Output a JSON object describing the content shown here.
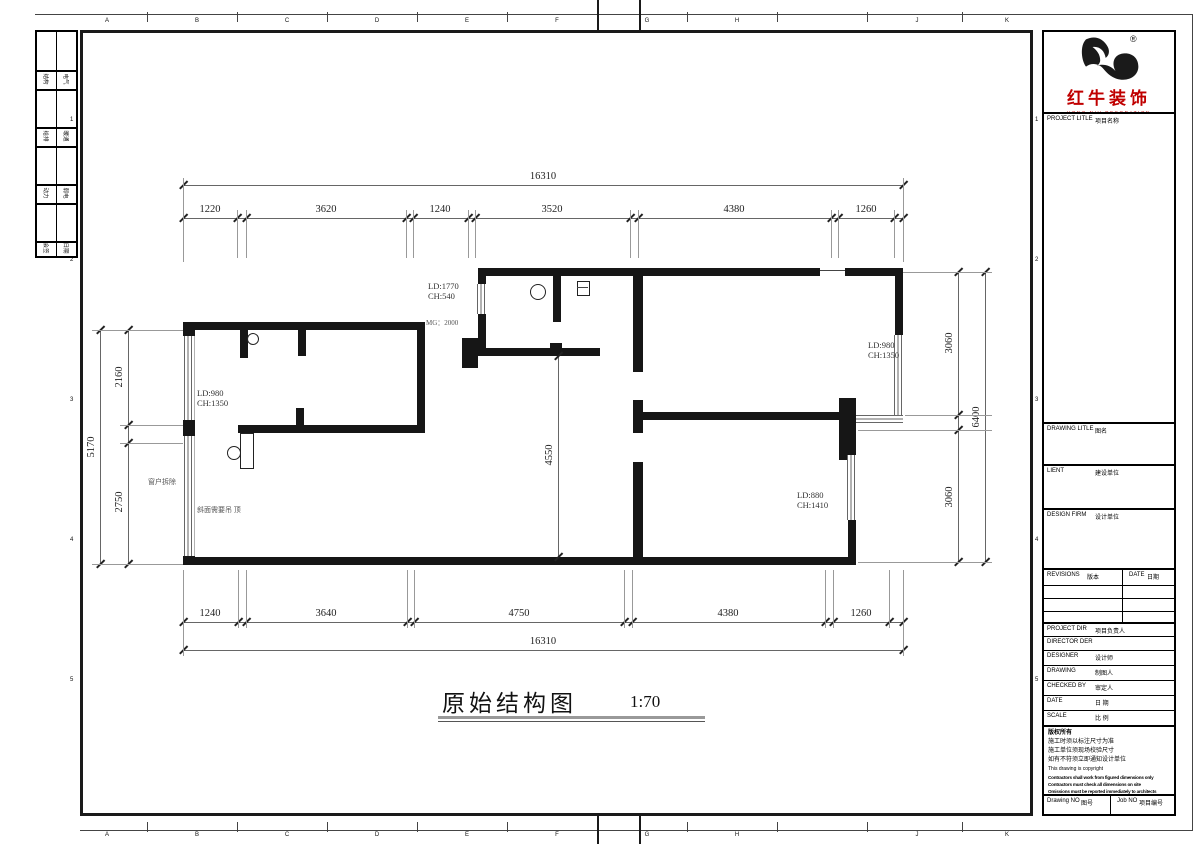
{
  "sheet": {
    "grid_letters": [
      "A",
      "B",
      "C",
      "D",
      "E",
      "F",
      "G",
      "H",
      "J",
      "K"
    ],
    "grid_numbers": [
      "1",
      "2",
      "3",
      "4",
      "5"
    ]
  },
  "signoff": {
    "rows": [
      {
        "l": "结构",
        "r": "电气"
      },
      {
        "l": "给排",
        "r": "暖通"
      },
      {
        "l": "动力",
        "r": "弱电"
      },
      {
        "l": "会签",
        "r": "日期"
      }
    ]
  },
  "plan": {
    "title": "原始结构图",
    "scale": "1:70",
    "dims_top": {
      "overall": "16310",
      "segments": [
        "1220",
        "3620",
        "1240",
        "3520",
        "4380",
        "1260"
      ]
    },
    "dims_bottom": {
      "overall": "16310",
      "segments": [
        "1240",
        "3640",
        "4750",
        "4380",
        "1260"
      ]
    },
    "dims_left": {
      "overall": "5170",
      "upper": "2160",
      "lower": "2750"
    },
    "dims_right": {
      "overall": "6400",
      "upper": "3060",
      "lower": "3060"
    },
    "dim_center": "4550",
    "labels": {
      "tc_ld": "LD:1770",
      "tc_ch": "CH:540",
      "mg": "MG：2000",
      "lt_ld": "LD:980",
      "lt_ch": "CH:1350",
      "rt_ld": "LD:980",
      "rt_ch": "CH:1350",
      "rm_ld": "LD:880",
      "rm_ch": "CH:1410",
      "window_note": "窗户拆除",
      "slope_note": "斜面需要吊 顶"
    }
  },
  "titleblock": {
    "brand": {
      "name": "红牛装饰",
      "caption": "HONG NIU DECORATION",
      "registered": "®"
    },
    "project_title": {
      "en": "PROJECT LITLE",
      "zh": "项目名称"
    },
    "drawing_title": {
      "en": "DRAWING LITLE",
      "zh": "图名"
    },
    "client": {
      "en": "LIENT",
      "zh": "建设单位"
    },
    "design_firm": {
      "en": "DESIGN FIRM",
      "zh": "设计单位"
    },
    "revisions": {
      "en": "REVISIONS",
      "zh": "版本"
    },
    "date_col": {
      "en": "DATE",
      "zh": "日期"
    },
    "project_dir": {
      "en": "PROJECT DIR",
      "zh": "项目负责人"
    },
    "director": {
      "en": "DIRECTOR DER",
      "zh": ""
    },
    "designer": {
      "en": "DESIGNER",
      "zh": "设计师"
    },
    "drawing_by": {
      "en": "DRAWING",
      "zh": "制图人"
    },
    "checked_by": {
      "en": "CHECKED BY",
      "zh": "审定人"
    },
    "date": {
      "en": "DATE",
      "zh": "日 期"
    },
    "scale": {
      "en": "SCALE",
      "zh": "比 例"
    },
    "copyright": {
      "line1": "版权所有",
      "line2": "施工时须以标注尺寸为准",
      "line3": "施工单位须现场校验尺寸",
      "line4": "如有不符须立即通知设计单位",
      "line5": "This drawing is copyright",
      "line6": "Contractors shall work from figured dimensions only",
      "line7": "Contractors must check all dimensions on site",
      "line8": "Omissions must be reported immediately to architects"
    },
    "drawing_no": {
      "en": "Drawing NO",
      "zh": "图号"
    },
    "job_no": {
      "en": "Job NO",
      "zh": "项目编号"
    }
  }
}
